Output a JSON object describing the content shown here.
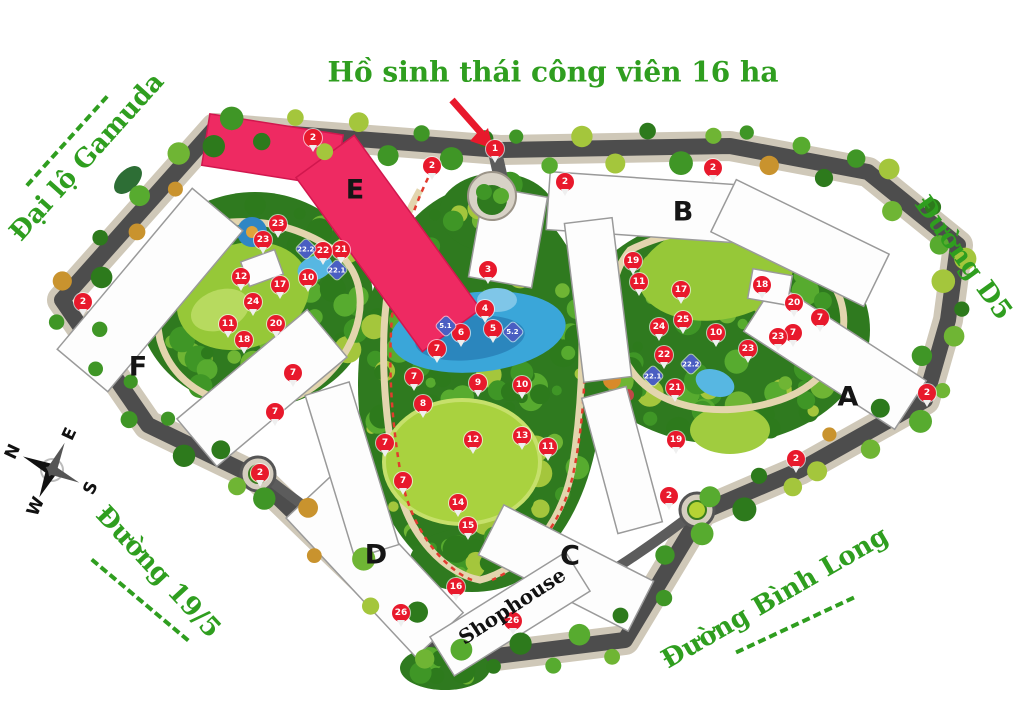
{
  "title": {
    "text": "Hồ sinh thái công viên 16 ha"
  },
  "roads": {
    "gamuda": "Đại lộ Gamuda",
    "d5": "Đường D5",
    "r195": "Đường 19/5",
    "binhlong": "Đường Bình Long"
  },
  "shophouse_label": "Shophouse",
  "compass": {
    "n": "N",
    "e": "E",
    "s": "S",
    "w": "W"
  },
  "colors": {
    "marker_red": "#e8192c",
    "marker_blue": "#4a5ec2",
    "highlight_pink": "#ee2a62",
    "label_green": "#2f9e1f"
  },
  "buildings": [
    {
      "label": "E",
      "x": 355,
      "y": 190
    },
    {
      "label": "B",
      "x": 683,
      "y": 212
    },
    {
      "label": "F",
      "x": 138,
      "y": 367
    },
    {
      "label": "A",
      "x": 848,
      "y": 397
    },
    {
      "label": "D",
      "x": 376,
      "y": 555
    },
    {
      "label": "C",
      "x": 570,
      "y": 556
    }
  ],
  "markers": {
    "items": [
      {
        "label": "1",
        "x": 495,
        "y": 149,
        "type": "red"
      },
      {
        "label": "2",
        "x": 313,
        "y": 138,
        "type": "red"
      },
      {
        "label": "2",
        "x": 432,
        "y": 166,
        "type": "red"
      },
      {
        "label": "2",
        "x": 565,
        "y": 182,
        "type": "red"
      },
      {
        "label": "2",
        "x": 713,
        "y": 168,
        "type": "red"
      },
      {
        "label": "2",
        "x": 83,
        "y": 302,
        "type": "red"
      },
      {
        "label": "2",
        "x": 927,
        "y": 393,
        "type": "red"
      },
      {
        "label": "2",
        "x": 796,
        "y": 459,
        "type": "red"
      },
      {
        "label": "2",
        "x": 669,
        "y": 496,
        "type": "red"
      },
      {
        "label": "2",
        "x": 260,
        "y": 473,
        "type": "red"
      },
      {
        "label": "3",
        "x": 488,
        "y": 270,
        "type": "red"
      },
      {
        "label": "4",
        "x": 485,
        "y": 309,
        "type": "red"
      },
      {
        "label": "5",
        "x": 493,
        "y": 329,
        "type": "red"
      },
      {
        "label": "6",
        "x": 461,
        "y": 333,
        "type": "red"
      },
      {
        "label": "7",
        "x": 437,
        "y": 349,
        "type": "red"
      },
      {
        "label": "7",
        "x": 414,
        "y": 377,
        "type": "red"
      },
      {
        "label": "7",
        "x": 385,
        "y": 443,
        "type": "red"
      },
      {
        "label": "7",
        "x": 403,
        "y": 481,
        "type": "red"
      },
      {
        "label": "7",
        "x": 293,
        "y": 373,
        "type": "red"
      },
      {
        "label": "7",
        "x": 275,
        "y": 412,
        "type": "red"
      },
      {
        "label": "7",
        "x": 820,
        "y": 318,
        "type": "red"
      },
      {
        "label": "7",
        "x": 793,
        "y": 333,
        "type": "red"
      },
      {
        "label": "8",
        "x": 423,
        "y": 404,
        "type": "red"
      },
      {
        "label": "9",
        "x": 478,
        "y": 383,
        "type": "red"
      },
      {
        "label": "10",
        "x": 308,
        "y": 278,
        "type": "red"
      },
      {
        "label": "10",
        "x": 522,
        "y": 385,
        "type": "red"
      },
      {
        "label": "10",
        "x": 716,
        "y": 333,
        "type": "red"
      },
      {
        "label": "11",
        "x": 228,
        "y": 324,
        "type": "red"
      },
      {
        "label": "11",
        "x": 548,
        "y": 447,
        "type": "red"
      },
      {
        "label": "11",
        "x": 639,
        "y": 282,
        "type": "red"
      },
      {
        "label": "12",
        "x": 241,
        "y": 277,
        "type": "red"
      },
      {
        "label": "12",
        "x": 473,
        "y": 440,
        "type": "red"
      },
      {
        "label": "13",
        "x": 522,
        "y": 436,
        "type": "red"
      },
      {
        "label": "14",
        "x": 458,
        "y": 503,
        "type": "red"
      },
      {
        "label": "15",
        "x": 468,
        "y": 526,
        "type": "red"
      },
      {
        "label": "16",
        "x": 456,
        "y": 587,
        "type": "red"
      },
      {
        "label": "17",
        "x": 280,
        "y": 285,
        "type": "red"
      },
      {
        "label": "17",
        "x": 681,
        "y": 290,
        "type": "red"
      },
      {
        "label": "18",
        "x": 244,
        "y": 340,
        "type": "red"
      },
      {
        "label": "18",
        "x": 762,
        "y": 285,
        "type": "red"
      },
      {
        "label": "19",
        "x": 633,
        "y": 261,
        "type": "red"
      },
      {
        "label": "19",
        "x": 676,
        "y": 440,
        "type": "red"
      },
      {
        "label": "20",
        "x": 276,
        "y": 324,
        "type": "red"
      },
      {
        "label": "20",
        "x": 794,
        "y": 303,
        "type": "red"
      },
      {
        "label": "21",
        "x": 341,
        "y": 250,
        "type": "red"
      },
      {
        "label": "21",
        "x": 675,
        "y": 388,
        "type": "red"
      },
      {
        "label": "22",
        "x": 323,
        "y": 251,
        "type": "red"
      },
      {
        "label": "22",
        "x": 664,
        "y": 355,
        "type": "red"
      },
      {
        "label": "23",
        "x": 278,
        "y": 224,
        "type": "red"
      },
      {
        "label": "23",
        "x": 263,
        "y": 240,
        "type": "red"
      },
      {
        "label": "23",
        "x": 778,
        "y": 337,
        "type": "red"
      },
      {
        "label": "23",
        "x": 748,
        "y": 349,
        "type": "red"
      },
      {
        "label": "24",
        "x": 253,
        "y": 302,
        "type": "red"
      },
      {
        "label": "24",
        "x": 659,
        "y": 327,
        "type": "red"
      },
      {
        "label": "25",
        "x": 683,
        "y": 320,
        "type": "red"
      },
      {
        "label": "26",
        "x": 401,
        "y": 613,
        "type": "red"
      },
      {
        "label": "26",
        "x": 513,
        "y": 621,
        "type": "red"
      },
      {
        "label": "5.1",
        "x": 446,
        "y": 326,
        "type": "blue"
      },
      {
        "label": "5.2",
        "x": 513,
        "y": 332,
        "type": "blue"
      },
      {
        "label": "22.2",
        "x": 306,
        "y": 249,
        "type": "blue"
      },
      {
        "label": "22.1",
        "x": 337,
        "y": 270,
        "type": "blue"
      },
      {
        "label": "22.2",
        "x": 691,
        "y": 364,
        "type": "blue"
      },
      {
        "label": "22.1",
        "x": 653,
        "y": 376,
        "type": "blue"
      }
    ]
  }
}
